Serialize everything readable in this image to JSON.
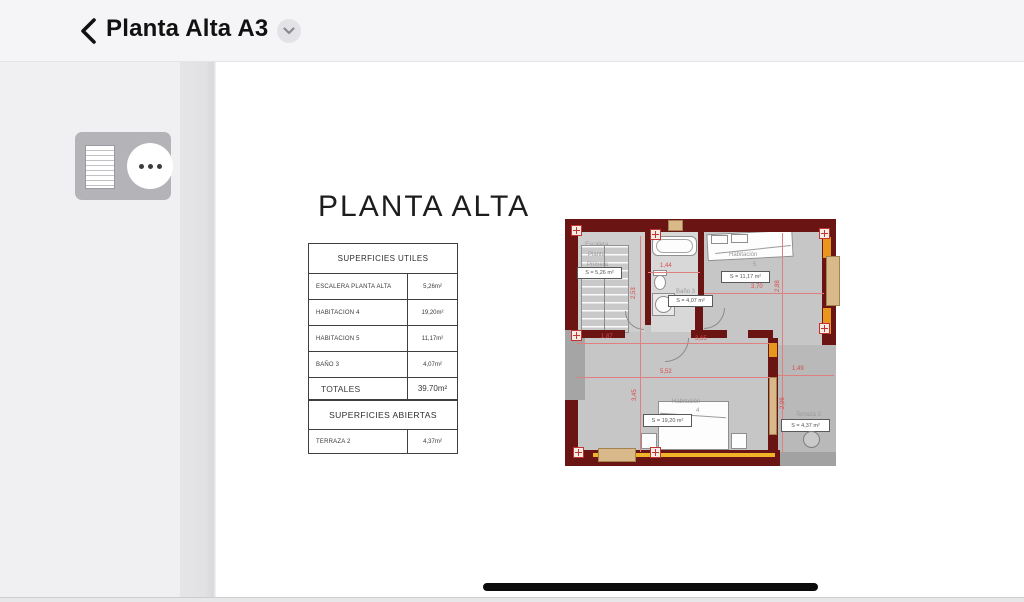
{
  "header": {
    "title": "Planta Alta A3"
  },
  "doc": {
    "heading": "PLANTA ALTA",
    "table": {
      "utiles_header": "SUPERFICIES UTILES",
      "rows": [
        {
          "label": "ESCALERA PLANTA ALTA",
          "value": "5,26m²"
        },
        {
          "label": "HABITACION 4",
          "value": "19,20m²"
        },
        {
          "label": "HABITACION 5",
          "value": "11,17m²"
        },
        {
          "label": "BAÑO 3",
          "value": "4,07m²"
        }
      ],
      "totals_label": "TOTALES",
      "totals_value": "39.70m²",
      "abiertas_header": "SUPERFICIES ABIERTAS",
      "abiertas_rows": [
        {
          "label": "TERRAZA 2",
          "value": "4,37m²"
        }
      ]
    },
    "plan": {
      "stair_line1": "Escalera",
      "stair_line2": "Planta",
      "stair_line3": "Primera",
      "stair_area": "S = 5,26 m²",
      "bath_label": "Baño 3",
      "bath_area": "S = 4,07 m²",
      "hab5_label": "Habitación",
      "hab5_number": "5",
      "hab5_area": "S = 11,17 m²",
      "hab4_label": "Habitación",
      "hab4_number": "4",
      "hab4_area": "S = 19,20 m²",
      "terraza_label": "Terraza 2",
      "terraza_area": "S = 4,37 m²",
      "dims": {
        "d144": "1,44",
        "d253": "2,53",
        "d187": "1,87",
        "d365": "3,65",
        "d552": "5,52",
        "d345": "3,45",
        "d370": "3,70",
        "d288": "2,88",
        "d149": "1,49",
        "d296": "2,96"
      }
    }
  },
  "colors": {
    "wall_maroon": "#6b1414",
    "dimension_red": "#d84b4b",
    "window_orange": "#e8971e",
    "window_tan": "#d9b98a",
    "header_bg": "#f5f5f7"
  }
}
